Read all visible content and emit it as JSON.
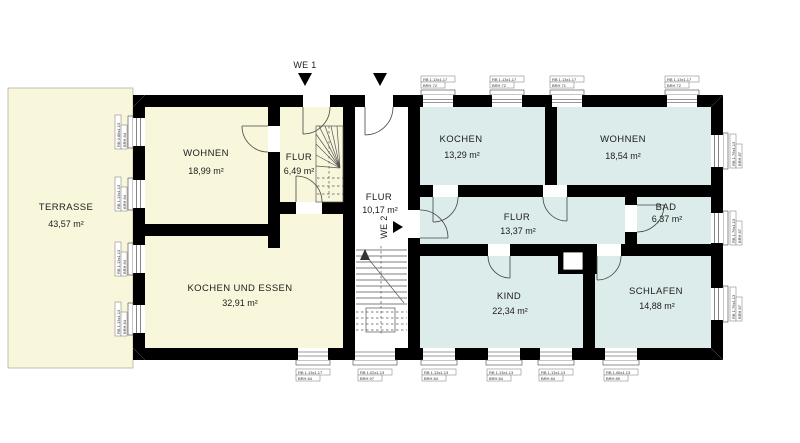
{
  "plan_title": "Grundriss",
  "we_units": {
    "we1": "WE 1",
    "we2": "WE 2"
  },
  "rooms": {
    "terrasse": {
      "name": "TERRASSE",
      "area": "43,57 m²"
    },
    "wohnen1": {
      "name": "WOHNEN",
      "area": "18,99 m²"
    },
    "flur1": {
      "name": "FLUR",
      "area": "6,49 m²"
    },
    "kochen_essen": {
      "name": "KOCHEN UND ESSEN",
      "area": "32,91 m²"
    },
    "flur_mitte": {
      "name": "FLUR",
      "area": "10,17 m²"
    },
    "kochen2": {
      "name": "KOCHEN",
      "area": "13,29 m²"
    },
    "wohnen2": {
      "name": "WOHNEN",
      "area": "18,54 m²"
    },
    "flur2": {
      "name": "FLUR",
      "area": "13,37 m²"
    },
    "bad": {
      "name": "BAD",
      "area": "6,37 m²"
    },
    "kind": {
      "name": "KIND",
      "area": "22,34 m²"
    },
    "schlafen": {
      "name": "SCHLAFEN",
      "area": "14,88 m²"
    }
  },
  "window_labels": {
    "top": [
      {
        "l1": "RB  1.13x1.17",
        "l2": "BRH 72"
      },
      {
        "l1": "RB  1.13x1.17",
        "l2": "BRH 72"
      },
      {
        "l1": "RB  1.13x1.17",
        "l2": "BRH 71"
      },
      {
        "l1": "RB  1.13x1.17",
        "l2": "BRH 72"
      }
    ],
    "bottom": [
      {
        "l1": "RB  1.13x1.17",
        "l2": "BRH 84"
      },
      {
        "l1": "RB  1.02x1.13",
        "l2": "BRH 97"
      },
      {
        "l1": "RB  1.13x1.13",
        "l2": "BRH 84"
      },
      {
        "l1": "RB  1.13x1.13",
        "l2": "BRH 84"
      },
      {
        "l1": "RB  1.13x1.13",
        "l2": "BRH 84"
      },
      {
        "l1": "RB  1.06x1.13",
        "l2": "BRH 89"
      }
    ],
    "left": [
      {
        "l1": "RB  0.88x1.13",
        "l2": "BRH 84"
      },
      {
        "l1": "RB  1.13x1.13",
        "l2": "BRH 84"
      },
      {
        "l1": "RB  1.13x1.13",
        "l2": "BRH 84"
      },
      {
        "l1": "RB  1.13x1.13",
        "l2": "BRH 84"
      }
    ],
    "right": [
      {
        "l1": "RB  1.76x1.13",
        "l2": "BRH 87"
      },
      {
        "l1": "RB  1.76x1.13",
        "l2": "BRH 87"
      },
      {
        "l1": "RB  1.76x1.13",
        "l2": "BRH 87"
      }
    ]
  },
  "colors": {
    "we1_fill": "#f8f7dc",
    "we2_fill": "#dcecea",
    "hall_fill": "#ffffff",
    "terrace_fill": "#f8f7dc",
    "wall": "#000000"
  }
}
